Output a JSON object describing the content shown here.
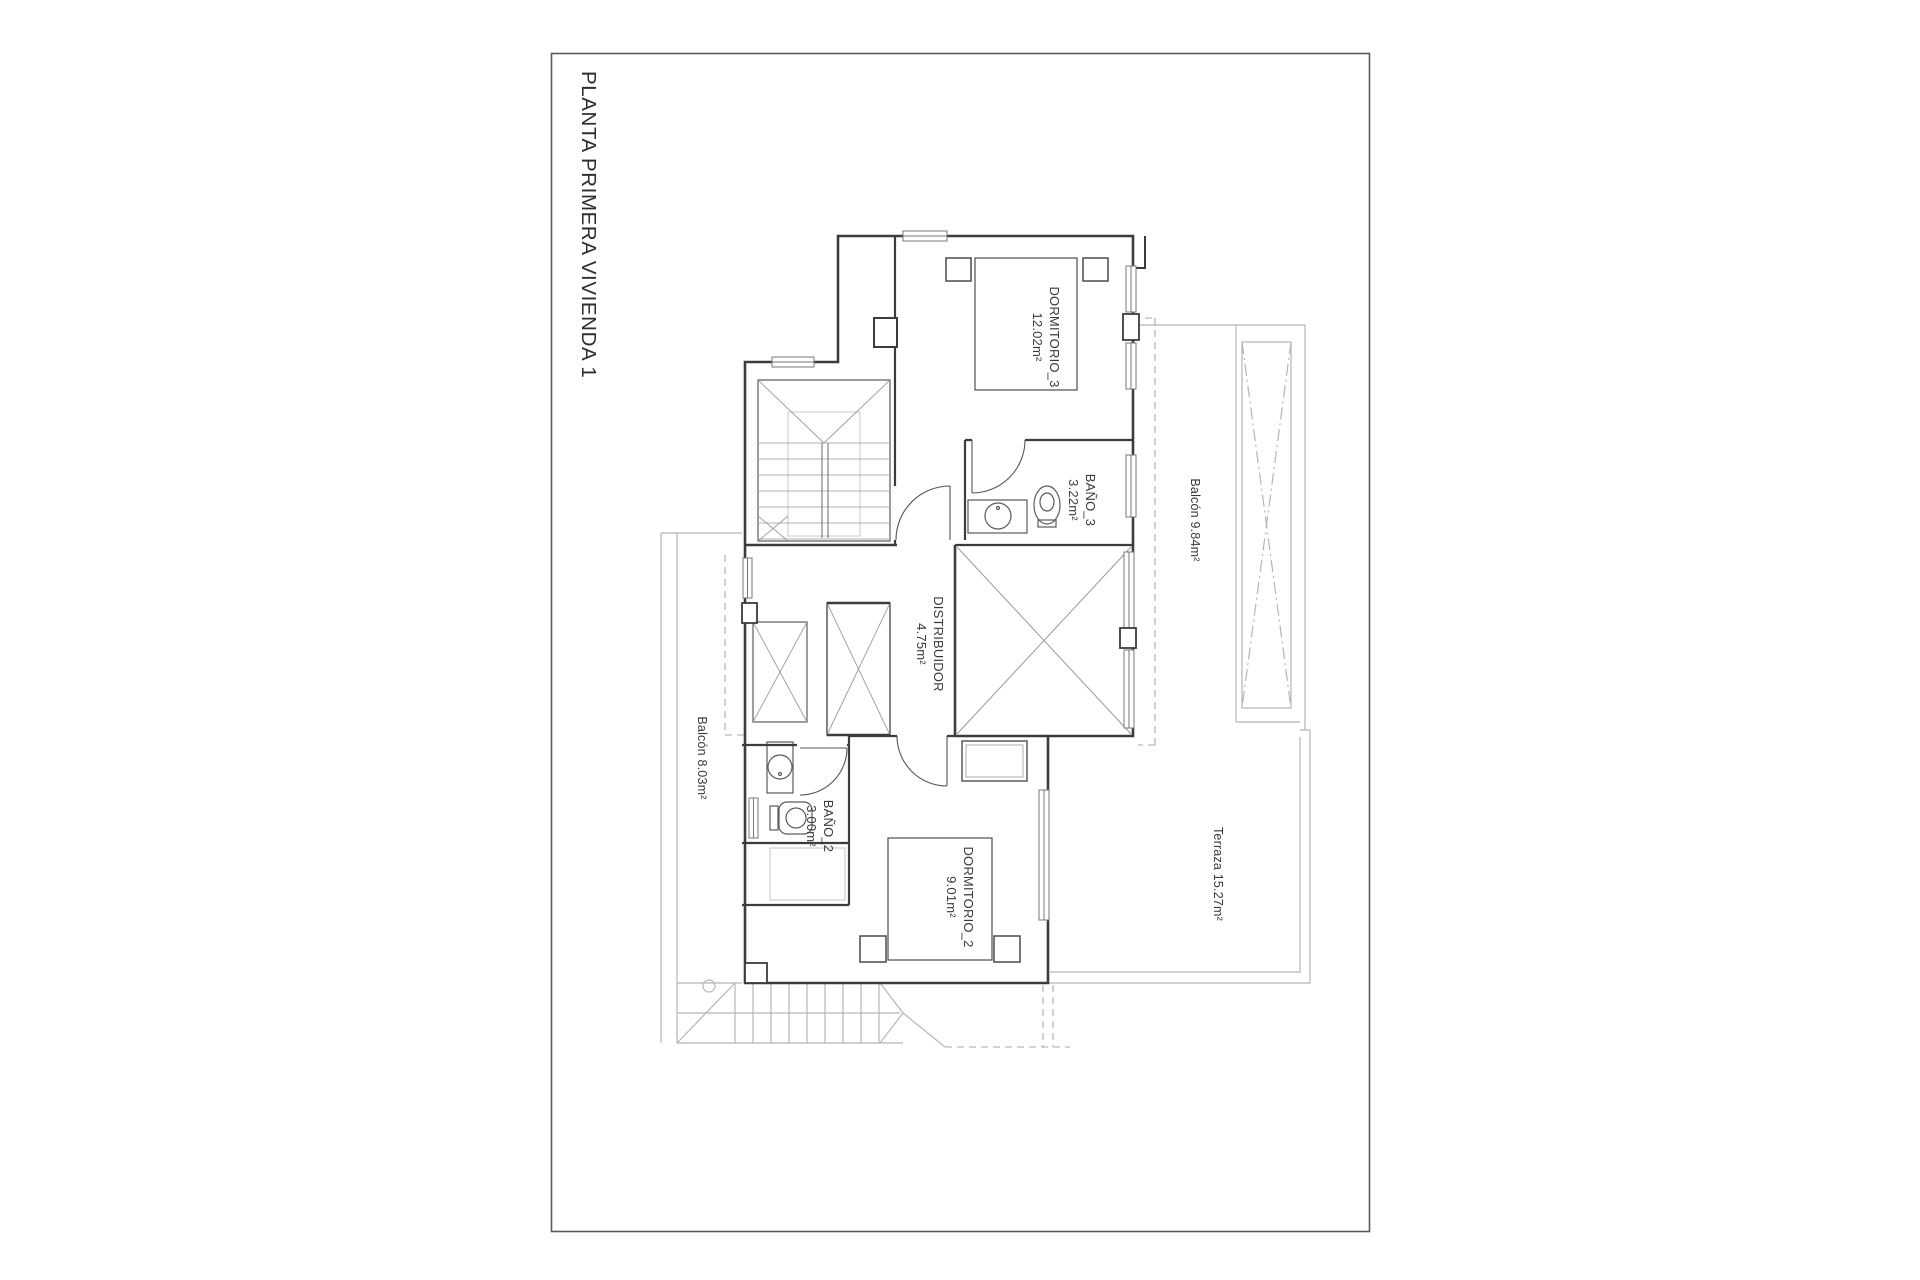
{
  "sheet": {
    "title": "PLANTA PRIMERA VIVIENDA 1",
    "rooms": {
      "dormitorio_3": {
        "name": "DORMITORIO_3",
        "area": "12.02m²"
      },
      "bano_3": {
        "name": "BAÑO_3",
        "area": "3.22m²"
      },
      "distribuidor": {
        "name": "DISTRIBUIDOR",
        "area": "4.75m²"
      },
      "bano_2": {
        "name": "BAÑO_2",
        "area": "3.00m²"
      },
      "dormitorio_2": {
        "name": "DORMITORIO_2",
        "area": "9.01m²"
      },
      "balcon_norte": {
        "label": "Balcón 9.84m²"
      },
      "balcon_oeste": {
        "label": "Balcón 8.03m²"
      },
      "terraza": {
        "label": "Terraza 15.27m²"
      }
    },
    "colors": {
      "wall": "#3c3c3c",
      "fixture": "#5a5a5a",
      "light_line": "#b5b5b5",
      "dashed_line": "#a9a9a9",
      "text": "#3a3a3a"
    }
  }
}
